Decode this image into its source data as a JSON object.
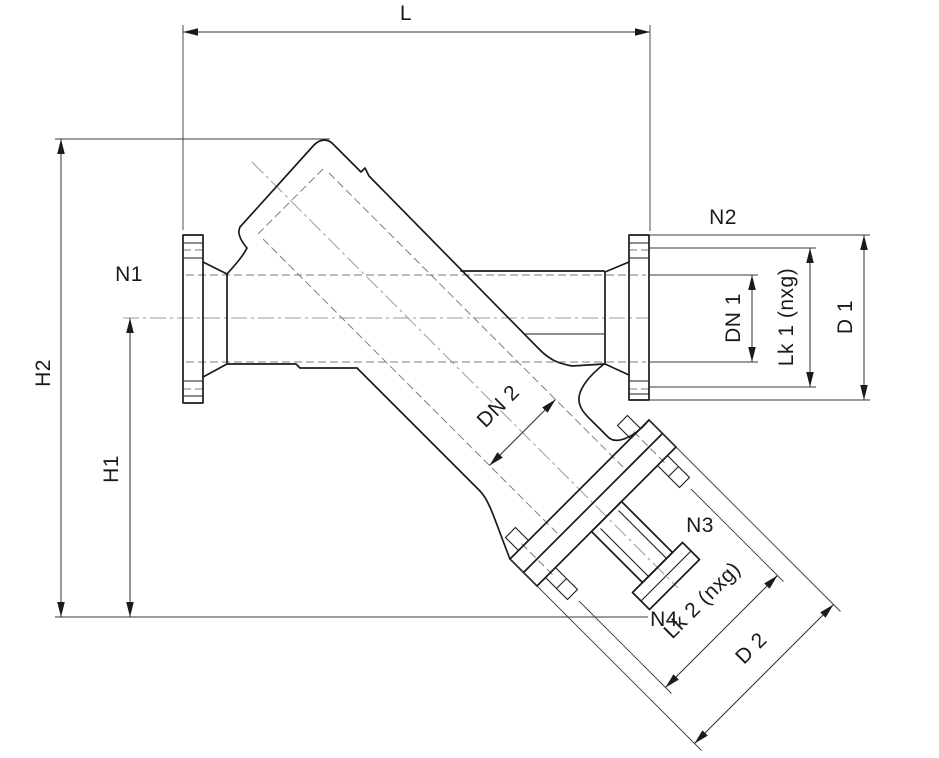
{
  "drawing": {
    "title": "Y-valve dimensional outline drawing",
    "labels": {
      "length": "L",
      "height_total": "H2",
      "height_center": "H1",
      "port1": "N1",
      "port2": "N2",
      "port3": "N3",
      "port4": "N4",
      "bore1": "DN 1",
      "bore2": "DN 2",
      "bolt_circle1": "Lk 1 (nxg)",
      "bolt_circle2": "Lk 2 (nxg)",
      "outer_dia1": "D 1",
      "outer_dia2": "D 2"
    },
    "colors": {
      "outline": "#1b1b1b",
      "dimension": "#303030",
      "centerline": "#9b9b9b",
      "hidden": "#7e7e7e",
      "background": "#ffffff"
    }
  }
}
